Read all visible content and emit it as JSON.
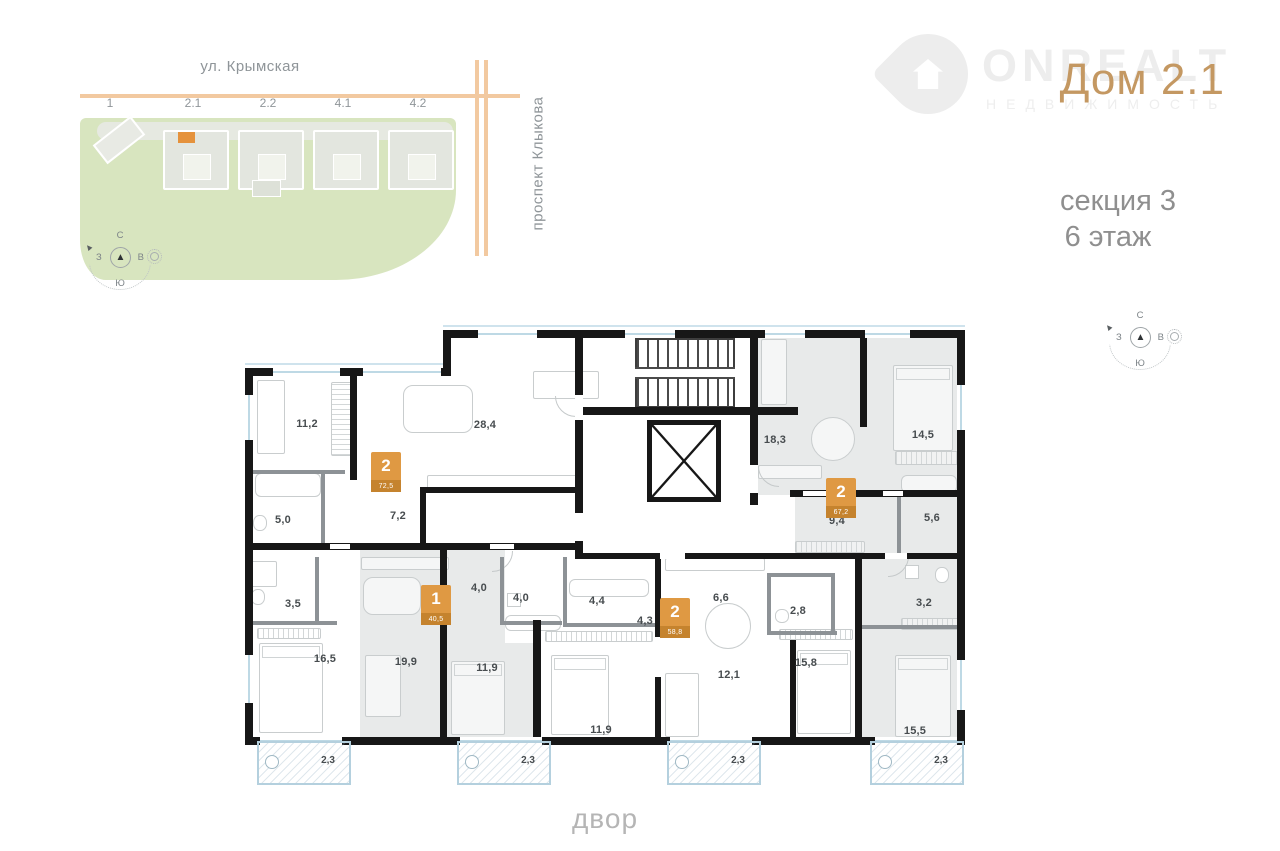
{
  "header": {
    "brand": "ONREALT",
    "brand_sub": "НЕДВИЖИМОСТЬ",
    "house": "Дом 2.1",
    "section": "секция 3",
    "floor": "6 этаж"
  },
  "site_map": {
    "street_top": "ул. Крымская",
    "street_right": "проспект Клыкова",
    "buildings": [
      "1",
      "2.1",
      "2.2",
      "4.1",
      "4.2"
    ]
  },
  "compass": {
    "north": "С",
    "south": "Ю",
    "west": "З",
    "east": "В",
    "needle": "▲",
    "tip": "▲"
  },
  "plan": {
    "apartments": [
      {
        "rooms": "2",
        "area": "72,5"
      },
      {
        "rooms": "2",
        "area": "67,2"
      },
      {
        "rooms": "1",
        "area": "40,5"
      },
      {
        "rooms": "2",
        "area": "58,8"
      }
    ],
    "room_areas": [
      "11,2",
      "28,4",
      "5,0",
      "7,2",
      "3,5",
      "16,5",
      "19,9",
      "11,9",
      "4,0",
      "4,0",
      "4,4",
      "4,3",
      "11,9",
      "6,6",
      "2,8",
      "12,1",
      "15,8",
      "18,3",
      "14,5",
      "9,4",
      "5,6",
      "3,2",
      "15,5"
    ],
    "balconies": [
      "2,3",
      "2,3",
      "2,3",
      "2,3"
    ]
  },
  "footer": {
    "yard": "двор"
  }
}
